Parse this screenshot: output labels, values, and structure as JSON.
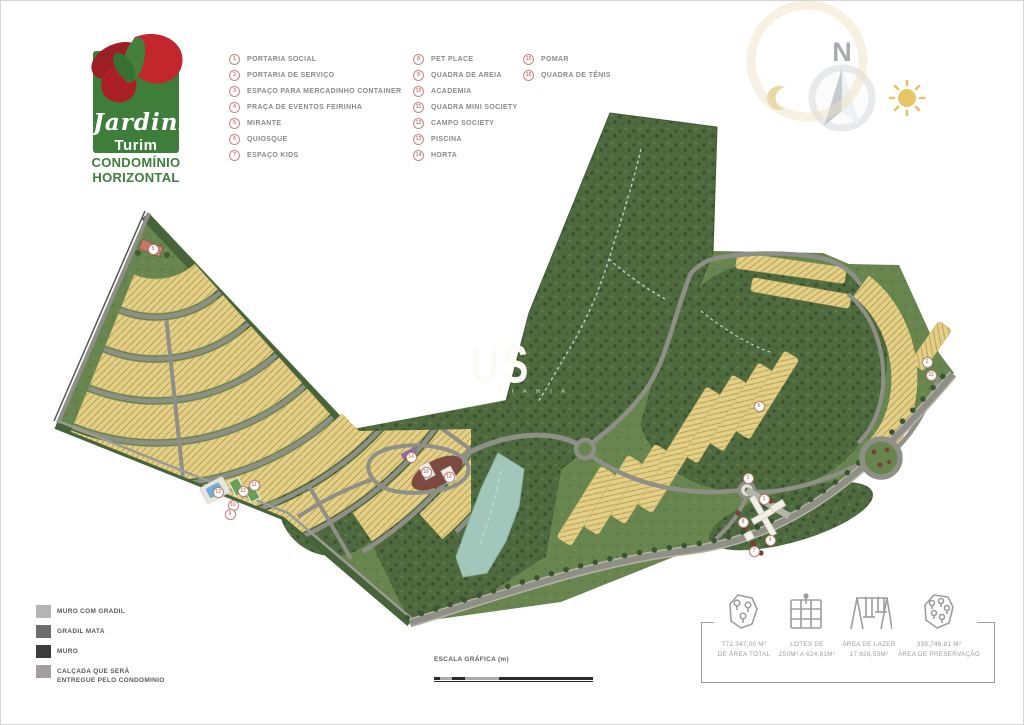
{
  "colors": {
    "logo-green": "#3e7d3a",
    "logo-red": "#c1272d",
    "legend-accent": "#c4897d",
    "legend-text": "#8a8a8a",
    "map-forest": "#4f6a3e",
    "map-grass": "#68854f",
    "map-lots": "#e3cf86",
    "map-road": "#8e9087",
    "map-lake": "#a3c6ba"
  },
  "logo": {
    "script": "Jardins",
    "sub": "Turim",
    "line1": "CONDOMÍNIO",
    "line2": "HORIZONTAL"
  },
  "legend": {
    "col1": [
      {
        "num": "1",
        "label": "PORTARIA SOCIAL"
      },
      {
        "num": "2",
        "label": "PORTARIA DE SERVIÇO"
      },
      {
        "num": "3",
        "label": "ESPAÇO PARA MERCADINHO CONTAINER"
      },
      {
        "num": "4",
        "label": "PRAÇA DE EVENTOS FEIRINHA"
      },
      {
        "num": "5",
        "label": "MIRANTE"
      },
      {
        "num": "6",
        "label": "QUIOSQUE"
      },
      {
        "num": "7",
        "label": "ESPAÇO KIDS"
      }
    ],
    "col2": [
      {
        "num": "8",
        "label": "PET PLACE"
      },
      {
        "num": "9",
        "label": "QUADRA DE AREIA"
      },
      {
        "num": "10",
        "label": "ACADEMIA"
      },
      {
        "num": "11",
        "label": "QUADRA MINI SOCIETY"
      },
      {
        "num": "12",
        "label": "CAMPO SOCIETY"
      },
      {
        "num": "13",
        "label": "PISCINA"
      },
      {
        "num": "14",
        "label": "HORTA"
      }
    ],
    "col3": [
      {
        "num": "15",
        "label": "POMAR"
      },
      {
        "num": "16",
        "label": "QUADRA DE TÊNIS"
      }
    ]
  },
  "compass": {
    "north": "N"
  },
  "map": {
    "watermark_big": "US",
    "watermark_small": "L I A R I A",
    "markers": [
      {
        "n": "5",
        "x": 151,
        "y": 247
      },
      {
        "n": "13",
        "x": 216,
        "y": 490
      },
      {
        "n": "12",
        "x": 241,
        "y": 489
      },
      {
        "n": "11",
        "x": 252,
        "y": 483
      },
      {
        "n": "10",
        "x": 231,
        "y": 503
      },
      {
        "n": "9",
        "x": 228,
        "y": 512
      },
      {
        "n": "14",
        "x": 409,
        "y": 455
      },
      {
        "n": "16",
        "x": 424,
        "y": 470
      },
      {
        "n": "16",
        "x": 447,
        "y": 475
      },
      {
        "n": "6",
        "x": 757,
        "y": 404
      },
      {
        "n": "3",
        "x": 746,
        "y": 476
      },
      {
        "n": "1",
        "x": 762,
        "y": 497
      },
      {
        "n": "8",
        "x": 741,
        "y": 520
      },
      {
        "n": "4",
        "x": 768,
        "y": 538
      },
      {
        "n": "7",
        "x": 752,
        "y": 549
      },
      {
        "n": "2",
        "x": 925,
        "y": 360
      },
      {
        "n": "15",
        "x": 929,
        "y": 373
      }
    ]
  },
  "materials": {
    "items": [
      {
        "label": "MURO COM GRADIL",
        "color": "#b5b5b5"
      },
      {
        "label": "GRADIL MATA",
        "color": "#6d6d6d"
      },
      {
        "label": "MURO",
        "color": "#3c3c3c"
      },
      {
        "label": "CALÇADA QUE SERÁ\nENTREGUE PELO CONDOMINIO",
        "color": "#a39f9f"
      }
    ]
  },
  "scale": {
    "title": "ESCALA GRÁFICA (m)",
    "ticks": [
      {
        "label": "0"
      },
      {
        "label": "2"
      },
      {
        "label": "10"
      },
      {
        "label": "20"
      },
      {
        "label": "40"
      },
      {
        "label": "100"
      }
    ]
  },
  "stats": {
    "items": [
      {
        "icon": "area-map-pins-icon",
        "line1": "772.347,00 M²",
        "line2": "DE ÁREA TOTAL"
      },
      {
        "icon": "lots-grid-icon",
        "line1": "LOTES DE",
        "line2": "250M² A 624,81M²"
      },
      {
        "icon": "playground-swing-icon",
        "line1": "ÁREA DE LAZER",
        "line2": "17.628,53M²"
      },
      {
        "icon": "preservation-map-icon",
        "line1": "339.746,81 M²",
        "line2": "ÁREA DE PRESERVAÇÃO"
      }
    ]
  }
}
